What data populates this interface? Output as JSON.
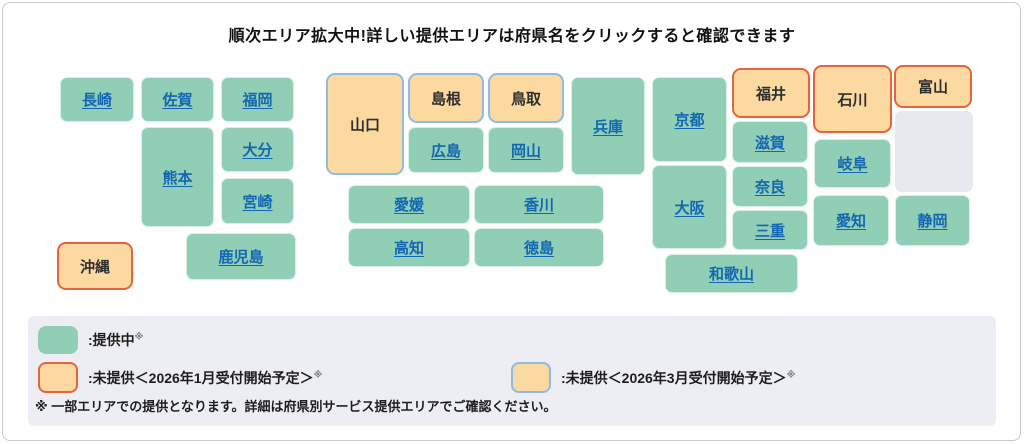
{
  "title": "順次エリア拡大中!詳しい提供エリアは府県名をクリックすると確認できます",
  "colors": {
    "available_fill": "#90CFB6",
    "not_provided_fill": "#FBD9A1",
    "jan2026_border": "#E8633C",
    "mar2026_border": "#8BBCE8",
    "empty_fill": "#E7E9EE",
    "link_blue": "#1366B2"
  },
  "map": {
    "prefectures": [
      {
        "id": "nagasaki",
        "label": "長崎",
        "status": "available",
        "clickable": true,
        "x": 60,
        "y": 77,
        "w": 74,
        "h": 45
      },
      {
        "id": "saga",
        "label": "佐賀",
        "status": "available",
        "clickable": true,
        "x": 141,
        "y": 77,
        "w": 73,
        "h": 45
      },
      {
        "id": "fukuoka",
        "label": "福岡",
        "status": "available",
        "clickable": true,
        "x": 221,
        "y": 77,
        "w": 73,
        "h": 45
      },
      {
        "id": "kumamoto",
        "label": "熊本",
        "status": "available",
        "clickable": true,
        "x": 141,
        "y": 127,
        "w": 73,
        "h": 100
      },
      {
        "id": "oita",
        "label": "大分",
        "status": "available",
        "clickable": true,
        "x": 221,
        "y": 127,
        "w": 73,
        "h": 45
      },
      {
        "id": "miyazaki",
        "label": "宮崎",
        "status": "available",
        "clickable": true,
        "x": 221,
        "y": 178,
        "w": 73,
        "h": 46
      },
      {
        "id": "kagoshima",
        "label": "鹿児島",
        "status": "available",
        "clickable": true,
        "x": 186,
        "y": 233,
        "w": 110,
        "h": 47
      },
      {
        "id": "okinawa",
        "label": "沖縄",
        "status": "jan2026",
        "clickable": false,
        "x": 57,
        "y": 242,
        "w": 76,
        "h": 48
      },
      {
        "id": "yamaguchi",
        "label": "山口",
        "status": "mar2026",
        "clickable": false,
        "x": 326,
        "y": 73,
        "w": 78,
        "h": 102
      },
      {
        "id": "shimane",
        "label": "島根",
        "status": "mar2026",
        "clickable": false,
        "x": 408,
        "y": 73,
        "w": 76,
        "h": 50
      },
      {
        "id": "tottori",
        "label": "鳥取",
        "status": "mar2026",
        "clickable": false,
        "x": 488,
        "y": 73,
        "w": 76,
        "h": 50
      },
      {
        "id": "hiroshima",
        "label": "広島",
        "status": "available",
        "clickable": true,
        "x": 408,
        "y": 127,
        "w": 76,
        "h": 46
      },
      {
        "id": "okayama",
        "label": "岡山",
        "status": "available",
        "clickable": true,
        "x": 488,
        "y": 127,
        "w": 76,
        "h": 46
      },
      {
        "id": "hyogo",
        "label": "兵庫",
        "status": "available",
        "clickable": true,
        "x": 571,
        "y": 77,
        "w": 74,
        "h": 98
      },
      {
        "id": "ehime",
        "label": "愛媛",
        "status": "available",
        "clickable": true,
        "x": 348,
        "y": 185,
        "w": 122,
        "h": 39
      },
      {
        "id": "kagawa",
        "label": "香川",
        "status": "available",
        "clickable": true,
        "x": 474,
        "y": 185,
        "w": 130,
        "h": 39
      },
      {
        "id": "kochi",
        "label": "高知",
        "status": "available",
        "clickable": true,
        "x": 348,
        "y": 228,
        "w": 122,
        "h": 39
      },
      {
        "id": "tokushima",
        "label": "徳島",
        "status": "available",
        "clickable": true,
        "x": 474,
        "y": 228,
        "w": 130,
        "h": 39
      },
      {
        "id": "kyoto",
        "label": "京都",
        "status": "available",
        "clickable": true,
        "x": 652,
        "y": 77,
        "w": 75,
        "h": 85
      },
      {
        "id": "osaka",
        "label": "大阪",
        "status": "available",
        "clickable": true,
        "x": 652,
        "y": 165,
        "w": 75,
        "h": 84
      },
      {
        "id": "fukui",
        "label": "福井",
        "status": "jan2026",
        "clickable": false,
        "x": 732,
        "y": 68,
        "w": 78,
        "h": 50
      },
      {
        "id": "shiga",
        "label": "滋賀",
        "status": "available",
        "clickable": true,
        "x": 732,
        "y": 121,
        "w": 76,
        "h": 42
      },
      {
        "id": "nara",
        "label": "奈良",
        "status": "available",
        "clickable": true,
        "x": 732,
        "y": 166,
        "w": 76,
        "h": 41
      },
      {
        "id": "mie",
        "label": "三重",
        "status": "available",
        "clickable": true,
        "x": 732,
        "y": 210,
        "w": 76,
        "h": 40
      },
      {
        "id": "wakayama",
        "label": "和歌山",
        "status": "available",
        "clickable": true,
        "x": 665,
        "y": 254,
        "w": 133,
        "h": 39
      },
      {
        "id": "ishikawa",
        "label": "石川",
        "status": "jan2026",
        "clickable": false,
        "x": 813,
        "y": 65,
        "w": 79,
        "h": 68
      },
      {
        "id": "gifu",
        "label": "岐阜",
        "status": "available",
        "clickable": true,
        "x": 814,
        "y": 139,
        "w": 77,
        "h": 49
      },
      {
        "id": "aichi",
        "label": "愛知",
        "status": "available",
        "clickable": true,
        "x": 813,
        "y": 195,
        "w": 76,
        "h": 51
      },
      {
        "id": "toyama",
        "label": "富山",
        "status": "jan2026",
        "clickable": false,
        "x": 894,
        "y": 65,
        "w": 78,
        "h": 43
      },
      {
        "id": "empty-region",
        "label": "",
        "status": "empty",
        "clickable": false,
        "x": 895,
        "y": 111,
        "w": 78,
        "h": 81
      },
      {
        "id": "shizuoka",
        "label": "静岡",
        "status": "available",
        "clickable": true,
        "x": 895,
        "y": 195,
        "w": 75,
        "h": 51
      }
    ]
  },
  "legend": {
    "items": [
      {
        "swatch": "available",
        "label": ":提供中",
        "mark": "※"
      },
      {
        "swatch": "jan2026",
        "label": ":未提供＜2026年1月受付開始予定＞",
        "mark": "※"
      },
      {
        "swatch": "mar2026",
        "label": ":未提供＜2026年3月受付開始予定＞",
        "mark": "※"
      }
    ],
    "note": "※ 一部エリアでの提供となります。詳細は府県別サービス提供エリアでご確認ください。"
  }
}
